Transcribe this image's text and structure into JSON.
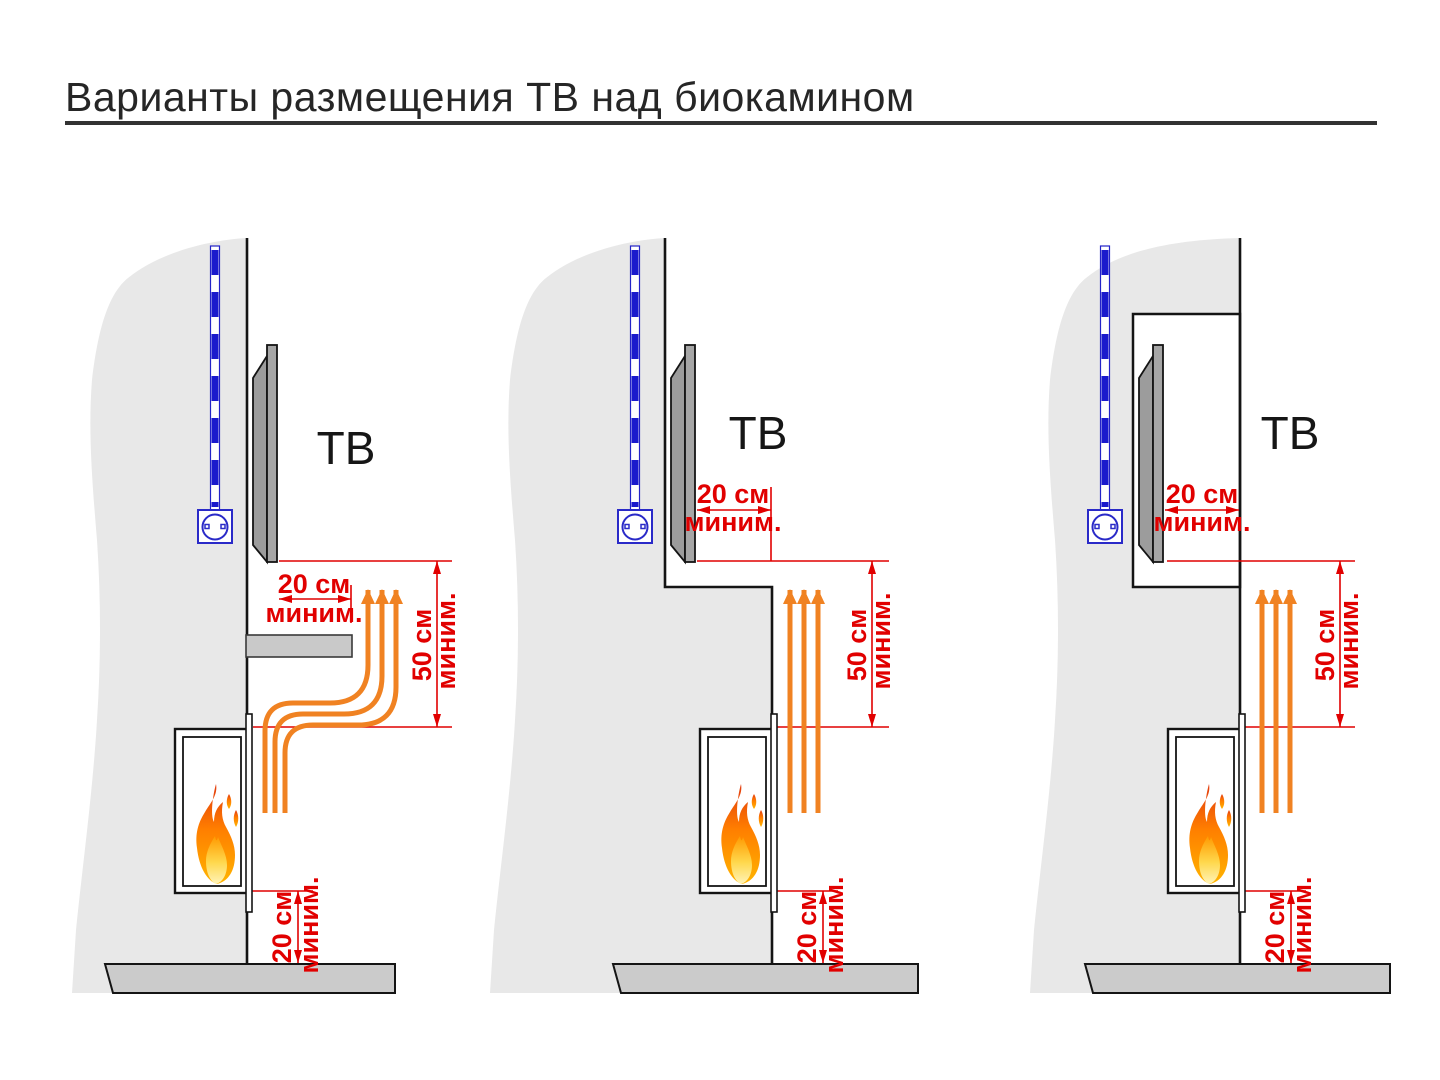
{
  "title": "Варианты размещения ТВ над биокамином",
  "diagrams": [
    {
      "variant": "shelf-between-tv-and-fireplace",
      "tv_label": "ТВ",
      "recess_dim": {
        "value": "20 см",
        "qualifier": "миним."
      },
      "clearance_dim": {
        "value": "50 см",
        "qualifier": "миним."
      },
      "floor_dim": {
        "value": "20 см",
        "qualifier": "миним."
      }
    },
    {
      "variant": "tv-recessed-behind-step",
      "tv_label": "ТВ",
      "recess_dim": {
        "value": "20 см",
        "qualifier": "миним."
      },
      "clearance_dim": {
        "value": "50 см",
        "qualifier": "миним."
      },
      "floor_dim": {
        "value": "20 см",
        "qualifier": "миним."
      }
    },
    {
      "variant": "tv-in-wall-niche",
      "tv_label": "ТВ",
      "recess_dim": {
        "value": "20 см",
        "qualifier": "миним."
      },
      "clearance_dim": {
        "value": "50 см",
        "qualifier": "миним."
      },
      "floor_dim": {
        "value": "20 см",
        "qualifier": "миним."
      }
    }
  ],
  "colors": {
    "dimension_red": "#e10000",
    "airflow_orange": "#f08222",
    "cable_blue": "#1a1acc",
    "wall_gray": "#e8e8e8",
    "floor_gray": "#cbcbcb",
    "tv_gray": "#a6a6a6"
  }
}
